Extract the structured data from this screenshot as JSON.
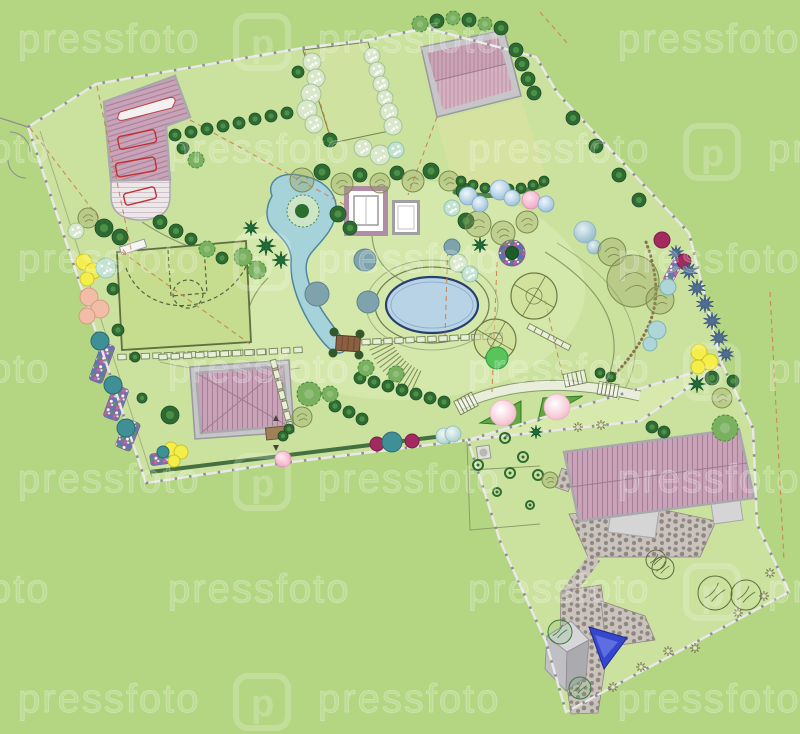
{
  "watermark": {
    "text": "pressfoto",
    "logo_letter": "p",
    "rows": 7,
    "row_height": 110,
    "first_y": 52,
    "col_step": 300,
    "offsets": [
      18,
      168
    ]
  },
  "palette": {
    "background": "#b4d683",
    "grass_light": "#c9e09a",
    "lawn": "#d6e3a0",
    "court": "#c6dc8e",
    "roof_base": "#c9a4b8",
    "roof_stripe": "#a87e98",
    "roof2_base": "#d7b3c1",
    "roof2_stripe": "#bb8fa6",
    "wall": "#a9a9ad",
    "drive_base": "#ede7ea",
    "drive_stripe": "#cfc0ca",
    "pool_water": "#b9d3e6",
    "pool_edge": "#27406e",
    "pond_water": "#a6d2da",
    "pond_edge": "#4d87a0",
    "stone": "#c9c2bd",
    "stone_dot": "#8f8780",
    "fence_light": "#e8e8e8",
    "fence_dark": "#8e8e8e",
    "hedge_fill": "#cfe3a6",
    "hedge_stroke": "#77895a",
    "path_line": "#8c9c6b",
    "path_light": "#e9eedb",
    "dash_orange": "#cd7a45",
    "gravel": "#8a6f52",
    "deep_blue": "#3647cf",
    "watermark": "#ffffff"
  },
  "plan": {
    "parcels": [
      {
        "name": "upper-parcel",
        "points": "28,127 96,84 302,48 368,40 426,28 536,57 558,94 689,233 722,364 640,421 468,440 260,466 146,483"
      },
      {
        "name": "lower-parcel",
        "points": "468,440 722,364 753,428 757,524 789,592 566,712 546,642 500,541"
      }
    ],
    "fences": [
      "28,127 96,84 302,48 368,40 426,28 536,57 558,94 689,233 722,364 640,421 468,440 260,466 146,483",
      "468,440 722,364 753,428 757,524 789,592 566,712 546,642 500,541"
    ],
    "hedges": [
      [
        122,
        357,
        262,
        352,
        13,
        1
      ],
      [
        366,
        342,
        498,
        336,
        13,
        1
      ],
      [
        163,
        357,
        298,
        350,
        12,
        1
      ],
      [
        274,
        364,
        290,
        426,
        7,
        1
      ],
      [
        532,
        328,
        566,
        346,
        6,
        1
      ]
    ],
    "dashes": [
      [
        30,
        128,
        128,
        256
      ],
      [
        97,
        86,
        132,
        254
      ],
      [
        122,
        252,
        250,
        344
      ],
      [
        437,
        117,
        408,
        195
      ],
      [
        497,
        262,
        492,
        392
      ],
      [
        448,
        242,
        445,
        336
      ],
      [
        545,
        300,
        563,
        378
      ],
      [
        540,
        12,
        568,
        44
      ],
      [
        770,
        292,
        784,
        560
      ],
      [
        190,
        120,
        345,
        205
      ],
      [
        305,
        52,
        332,
        142
      ]
    ],
    "stairs": [
      [
        456,
        396,
        20,
        15,
        -28,
        5
      ],
      [
        564,
        372,
        22,
        13,
        -12,
        5
      ],
      [
        598,
        383,
        20,
        13,
        10,
        5
      ]
    ],
    "fan": {
      "cx": 445,
      "cy": 318,
      "r1": 58,
      "r2": 82,
      "a1": 2.0,
      "a2": 2.8,
      "n": 13
    },
    "confetti": [
      [
        95,
        343,
        14,
        40,
        20
      ],
      [
        108,
        386,
        16,
        34,
        20
      ],
      [
        120,
        420,
        16,
        30,
        22
      ],
      [
        150,
        452,
        30,
        12,
        -8
      ],
      [
        668,
        258,
        10,
        26,
        28
      ]
    ],
    "flora": [
      [
        "con",
        175,
        135,
        6
      ],
      [
        "con",
        191,
        132,
        6
      ],
      [
        "con",
        207,
        129,
        6
      ],
      [
        "con",
        223,
        126,
        6
      ],
      [
        "con",
        239,
        123,
        6
      ],
      [
        "con",
        255,
        119,
        6
      ],
      [
        "con",
        271,
        116,
        6
      ],
      [
        "con",
        287,
        113,
        6
      ],
      [
        "scrib",
        88,
        218,
        10
      ],
      [
        "con",
        104,
        228,
        9
      ],
      [
        "con",
        120,
        237,
        8
      ],
      [
        "speck",
        76,
        231,
        8
      ],
      [
        "con",
        160,
        222,
        7
      ],
      [
        "con",
        176,
        231,
        7
      ],
      [
        "con",
        191,
        239,
        6
      ],
      [
        "decid",
        207,
        249,
        8
      ],
      [
        "con",
        222,
        258,
        6
      ],
      [
        "decid",
        196,
        160,
        8
      ],
      [
        "con",
        183,
        148,
        6
      ],
      [
        "speck",
        312,
        62,
        9
      ],
      [
        "speck",
        316,
        78,
        9
      ],
      [
        "speck",
        311,
        94,
        10
      ],
      [
        "speck",
        307,
        110,
        10
      ],
      [
        "speck",
        314,
        124,
        9
      ],
      [
        "con",
        298,
        72,
        6
      ],
      [
        "con",
        330,
        140,
        7
      ],
      [
        "speck",
        372,
        56,
        8
      ],
      [
        "speck",
        377,
        70,
        8
      ],
      [
        "speck",
        381,
        84,
        8
      ],
      [
        "speck",
        385,
        98,
        8
      ],
      [
        "speck",
        389,
        112,
        9
      ],
      [
        "speck",
        393,
        126,
        9
      ],
      [
        "speck",
        363,
        148,
        9
      ],
      [
        "speck",
        380,
        155,
        10
      ],
      [
        "mint",
        396,
        150,
        8
      ],
      [
        "decid",
        420,
        24,
        8
      ],
      [
        "con",
        437,
        21,
        7
      ],
      [
        "decid",
        453,
        18,
        7
      ],
      [
        "con",
        469,
        20,
        7
      ],
      [
        "decid",
        485,
        24,
        7
      ],
      [
        "con",
        501,
        28,
        7
      ],
      [
        "con",
        516,
        50,
        7
      ],
      [
        "con",
        522,
        64,
        7
      ],
      [
        "con",
        528,
        79,
        7
      ],
      [
        "con",
        534,
        93,
        7
      ],
      [
        "con",
        573,
        118,
        7
      ],
      [
        "con",
        596,
        146,
        7
      ],
      [
        "con",
        619,
        175,
        7
      ],
      [
        "con",
        639,
        200,
        7
      ],
      [
        "scrib",
        302,
        180,
        12
      ],
      [
        "con",
        322,
        172,
        8
      ],
      [
        "scrib",
        342,
        184,
        11
      ],
      [
        "con",
        360,
        175,
        7
      ],
      [
        "scrib",
        380,
        183,
        10
      ],
      [
        "con",
        397,
        173,
        7
      ],
      [
        "scrib",
        413,
        181,
        11
      ],
      [
        "con",
        431,
        171,
        8
      ],
      [
        "scrib",
        449,
        181,
        10
      ],
      [
        "con",
        464,
        191,
        8
      ],
      [
        "con",
        338,
        214,
        8
      ],
      [
        "con",
        350,
        228,
        7
      ],
      [
        "mint",
        452,
        208,
        8
      ],
      [
        "con",
        466,
        221,
        8
      ],
      [
        "con",
        461,
        181,
        5
      ],
      [
        "con",
        473,
        185,
        5
      ],
      [
        "con",
        485,
        188,
        5
      ],
      [
        "con",
        497,
        189,
        5
      ],
      [
        "con",
        509,
        189,
        5
      ],
      [
        "con",
        521,
        188,
        5
      ],
      [
        "con",
        533,
        185,
        5
      ],
      [
        "con",
        544,
        181,
        5
      ],
      [
        "scrib",
        478,
        224,
        13
      ],
      [
        "scrib",
        503,
        233,
        12
      ],
      [
        "scrib",
        527,
        222,
        11
      ],
      [
        "palm",
        480,
        245,
        8
      ],
      [
        "speck",
        458,
        263,
        9
      ],
      [
        "mint",
        470,
        274,
        8
      ],
      [
        "slate",
        452,
        247,
        8
      ],
      [
        "sphB",
        468,
        196,
        9
      ],
      [
        "sphB",
        480,
        204,
        8
      ],
      [
        "sphB",
        500,
        190,
        10
      ],
      [
        "sphB",
        512,
        198,
        8
      ],
      [
        "sphP",
        531,
        200,
        9
      ],
      [
        "sphB",
        546,
        204,
        8
      ],
      [
        "sphSt",
        585,
        232,
        11
      ],
      [
        "sphSt",
        594,
        247,
        7
      ],
      [
        "scrib",
        612,
        252,
        14
      ],
      [
        "scrib",
        633,
        281,
        26
      ],
      [
        "scrib",
        660,
        300,
        14
      ],
      [
        "tealp",
        668,
        287,
        8
      ],
      [
        "tealp",
        657,
        330,
        9
      ],
      [
        "tealp",
        650,
        344,
        7
      ],
      [
        "mag",
        662,
        240,
        8
      ],
      [
        "spr",
        676,
        253,
        8
      ],
      [
        "mag",
        684,
        261,
        7
      ],
      [
        "spr",
        689,
        271,
        9
      ],
      [
        "spr",
        697,
        288,
        9
      ],
      [
        "spr",
        705,
        304,
        9
      ],
      [
        "spr",
        712,
        321,
        9
      ],
      [
        "spr",
        719,
        338,
        9
      ],
      [
        "spr",
        726,
        354,
        8
      ],
      [
        "yel",
        699,
        352,
        8
      ],
      [
        "yel",
        710,
        362,
        8
      ],
      [
        "yel",
        698,
        367,
        7
      ],
      [
        "palm",
        697,
        384,
        9
      ],
      [
        "con",
        712,
        378,
        7
      ],
      [
        "scrib",
        722,
        398,
        10
      ],
      [
        "con",
        733,
        381,
        6
      ],
      [
        "con",
        652,
        427,
        6
      ],
      [
        "con",
        664,
        432,
        6
      ],
      [
        "big",
        534,
        296,
        23
      ],
      [
        "big",
        495,
        340,
        21
      ],
      [
        "grn",
        497,
        358,
        11
      ],
      [
        "slate",
        365,
        260,
        11
      ],
      [
        "slate",
        368,
        302,
        11
      ],
      [
        "slate",
        317,
        294,
        12
      ],
      [
        "palm",
        251,
        228,
        8
      ],
      [
        "palm",
        266,
        246,
        10
      ],
      [
        "decid",
        243,
        257,
        9
      ],
      [
        "palm",
        281,
        260,
        9
      ],
      [
        "decid",
        257,
        270,
        9
      ],
      [
        "con",
        360,
        378,
        6
      ],
      [
        "con",
        374,
        382,
        6
      ],
      [
        "con",
        388,
        386,
        6
      ],
      [
        "con",
        402,
        390,
        6
      ],
      [
        "con",
        416,
        394,
        6
      ],
      [
        "con",
        430,
        398,
        6
      ],
      [
        "con",
        444,
        402,
        6
      ],
      [
        "decid",
        366,
        368,
        8
      ],
      [
        "decid",
        396,
        374,
        8
      ],
      [
        "con",
        335,
        406,
        6
      ],
      [
        "con",
        349,
        412,
        6
      ],
      [
        "con",
        362,
        419,
        6
      ],
      [
        "decid",
        330,
        394,
        8
      ],
      [
        "yel",
        84,
        262,
        8
      ],
      [
        "yel",
        93,
        271,
        8
      ],
      [
        "yel",
        87,
        279,
        7
      ],
      [
        "mint",
        106,
        268,
        10
      ],
      [
        "peach",
        89,
        297,
        9
      ],
      [
        "peach",
        100,
        309,
        9
      ],
      [
        "peach",
        87,
        316,
        8
      ],
      [
        "con",
        113,
        289,
        6
      ],
      [
        "con",
        118,
        330,
        6
      ],
      [
        "teal",
        100,
        341,
        9
      ],
      [
        "teal",
        113,
        385,
        9
      ],
      [
        "teal",
        126,
        428,
        9
      ],
      [
        "con",
        135,
        357,
        5
      ],
      [
        "con",
        142,
        398,
        5
      ],
      [
        "con",
        170,
        415,
        9
      ],
      [
        "yel",
        171,
        449,
        7
      ],
      [
        "yel",
        181,
        452,
        7
      ],
      [
        "yel",
        174,
        461,
        6
      ],
      [
        "teal",
        163,
        452,
        6
      ],
      [
        "decid",
        309,
        394,
        12
      ],
      [
        "scrib",
        302,
        417,
        10
      ],
      [
        "con",
        289,
        429,
        5
      ],
      [
        "con",
        283,
        436,
        5
      ],
      [
        "sphP",
        283,
        459,
        8
      ],
      [
        "mag",
        377,
        444,
        7
      ],
      [
        "teal",
        392,
        442,
        10
      ],
      [
        "mag",
        412,
        441,
        7
      ],
      [
        "sphTp",
        444,
        436,
        8
      ],
      [
        "sphTp",
        453,
        434,
        8
      ],
      [
        "con",
        600,
        373,
        5
      ],
      [
        "con",
        611,
        377,
        5
      ],
      [
        "star",
        578,
        427,
        5
      ],
      [
        "star",
        601,
        425,
        5
      ],
      [
        "ring",
        505,
        438,
        5
      ],
      [
        "ring",
        523,
        457,
        5
      ],
      [
        "ring",
        538,
        475,
        5
      ],
      [
        "ring",
        478,
        465,
        5
      ],
      [
        "ring",
        510,
        473,
        5
      ],
      [
        "ring",
        530,
        505,
        4
      ],
      [
        "ring",
        497,
        492,
        4
      ],
      [
        "palm",
        536,
        432,
        7
      ],
      [
        "decid",
        725,
        428,
        13
      ],
      [
        "scrib",
        550,
        480,
        8
      ],
      [
        "out",
        656,
        560,
        10
      ],
      [
        "outg",
        560,
        632,
        12
      ],
      [
        "outg",
        580,
        688,
        11
      ],
      [
        "out",
        715,
        593,
        17
      ],
      [
        "out",
        746,
        595,
        15
      ],
      [
        "out",
        663,
        568,
        11
      ],
      [
        "star",
        770,
        573,
        5
      ],
      [
        "star",
        764,
        596,
        5
      ],
      [
        "star",
        738,
        613,
        5
      ],
      [
        "star",
        695,
        648,
        5
      ],
      [
        "star",
        668,
        651,
        5
      ],
      [
        "star",
        641,
        667,
        5
      ],
      [
        "star",
        613,
        687,
        5
      ],
      [
        "sphG",
        503,
        413,
        13
      ],
      [
        "sphG",
        557,
        407,
        13
      ]
    ]
  }
}
